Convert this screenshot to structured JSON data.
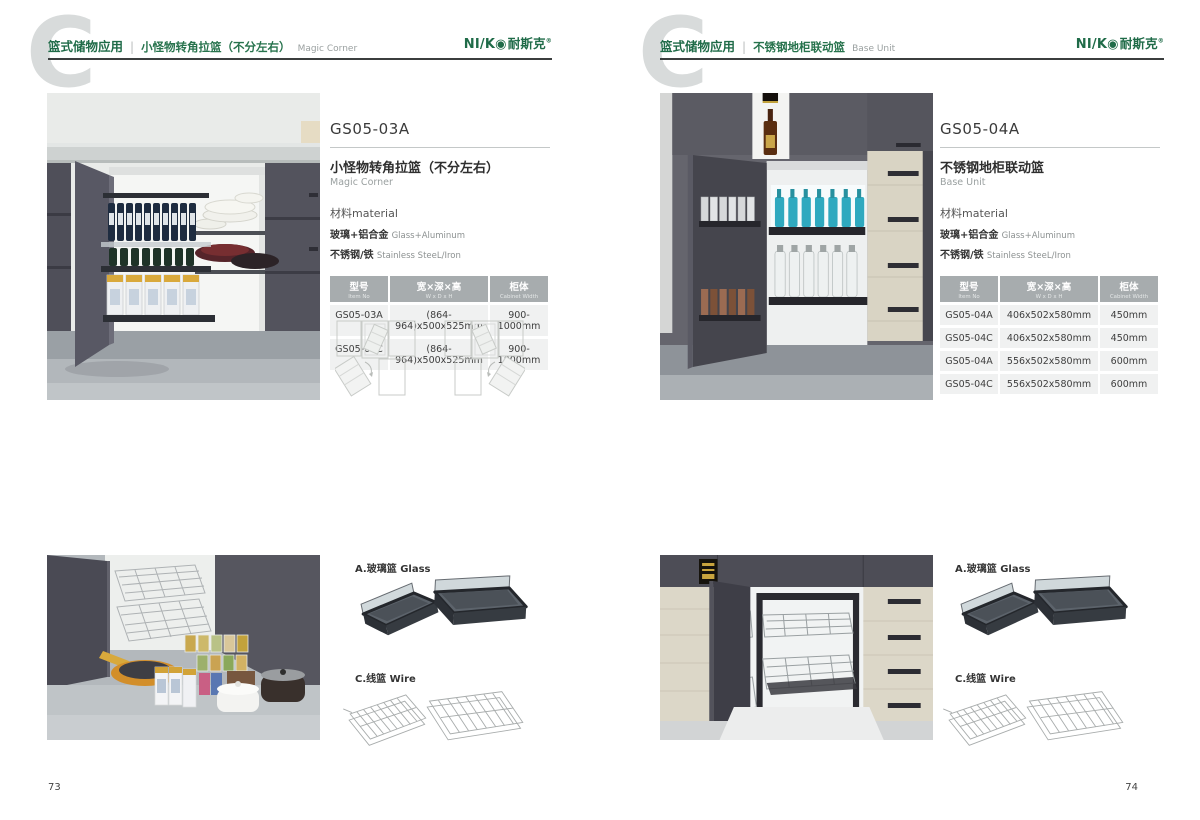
{
  "logo": {
    "latin": "NI/K◉",
    "cn": "耐斯克",
    "reg": "®"
  },
  "pages": [
    {
      "watermark": "C",
      "page_number": "73",
      "header": {
        "category": "篮式储物应用",
        "sep": "|",
        "title_cn": "小怪物转角拉篮（不分左右）",
        "title_en": "Magic Corner"
      },
      "product": {
        "model": "GS05-03A",
        "name_cn": "小怪物转角拉篮（不分左右）",
        "name_en": "Magic Corner",
        "material_heading": "材料material",
        "materials": [
          {
            "cn": "玻璃+铝合金",
            "en": "Glass+Aluminum"
          },
          {
            "cn": "不锈钢/铁",
            "en": "Stainless SteeL/Iron"
          }
        ]
      },
      "table": {
        "headers": [
          {
            "cn": "型号",
            "en": "Item No"
          },
          {
            "cn": "宽×深×高",
            "en": "W x D x H"
          },
          {
            "cn": "柜体",
            "en": "Cabinet Width"
          }
        ],
        "rows": [
          [
            "GS05-03A",
            "(864-964)x500x525mm",
            "900-1000mm"
          ],
          [
            "GS05-03C",
            "(864-964)x500x525mm",
            "900-1000mm"
          ]
        ]
      },
      "components": {
        "glass": "A.玻璃篮 Glass",
        "wire": "C.线篮 Wire"
      }
    },
    {
      "watermark": "C",
      "page_number": "74",
      "header": {
        "category": "篮式储物应用",
        "sep": "|",
        "title_cn": "不锈钢地柜联动篮",
        "title_en": "Base Unit"
      },
      "product": {
        "model": "GS05-04A",
        "name_cn": "不锈钢地柜联动篮",
        "name_en": "Base Unit",
        "material_heading": "材料material",
        "materials": [
          {
            "cn": "玻璃+铝合金",
            "en": "Glass+Aluminum"
          },
          {
            "cn": "不锈钢/铁",
            "en": "Stainless SteeL/Iron"
          }
        ]
      },
      "table": {
        "headers": [
          {
            "cn": "型号",
            "en": "Item No"
          },
          {
            "cn": "宽×深×高",
            "en": "W x D x H"
          },
          {
            "cn": "柜体",
            "en": "Cabinet Width"
          }
        ],
        "rows": [
          [
            "GS05-04A",
            "406x502x580mm",
            "450mm"
          ],
          [
            "GS05-04C",
            "406x502x580mm",
            "450mm"
          ],
          [
            "GS05-04A",
            "556x502x580mm",
            "600mm"
          ],
          [
            "GS05-04C",
            "556x502x580mm",
            "600mm"
          ]
        ]
      },
      "components": {
        "glass": "A.玻璃篮 Glass",
        "wire": "C.线篮 Wire"
      }
    }
  ]
}
